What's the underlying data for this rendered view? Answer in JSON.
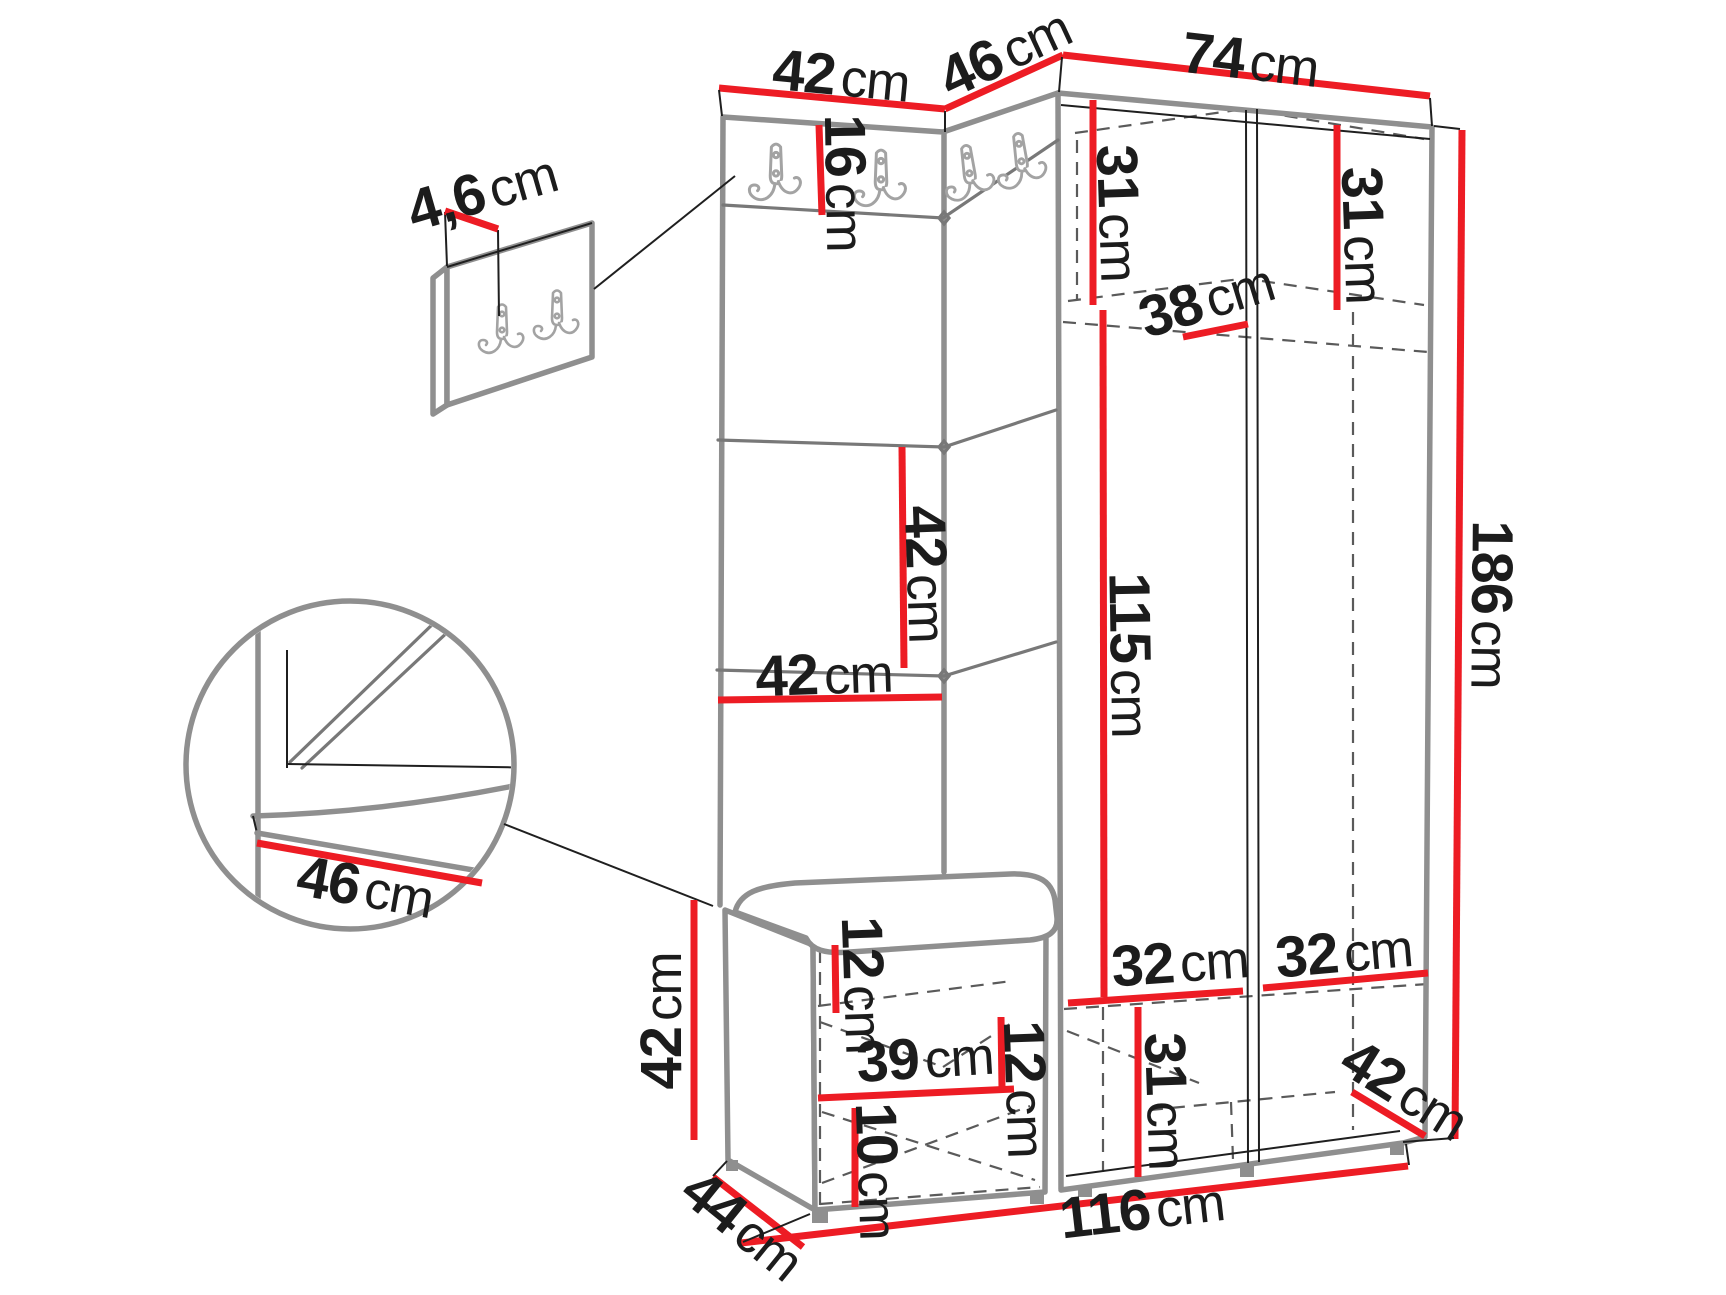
{
  "colors": {
    "dimension_red": "#ed1c24",
    "outline_grey": "#8f8f8f",
    "seam_grey": "#787878",
    "line_black": "#1f1f1f",
    "dash_grey": "#5a5a5a",
    "hook_grey": "#a3a3a3",
    "text_black": "#1c1c1c"
  },
  "dims": {
    "panel_top_width": {
      "v": "42",
      "u": "cm"
    },
    "corner_top_width": {
      "v": "46",
      "u": "cm"
    },
    "wardrobe_top_width": {
      "v": "74",
      "u": "cm"
    },
    "hook_panel_thickness": {
      "v": "4,6",
      "u": "cm"
    },
    "hook_header_height": {
      "v": "16",
      "u": "cm"
    },
    "top_shelf_left_height": {
      "v": "31",
      "u": "cm"
    },
    "top_shelf_right_height": {
      "v": "31",
      "u": "cm"
    },
    "top_shelf_depth": {
      "v": "38",
      "u": "cm"
    },
    "cushion_height": {
      "v": "42",
      "u": "cm"
    },
    "cushion_width": {
      "v": "42",
      "u": "cm"
    },
    "open_section_height": {
      "v": "115",
      "u": "cm"
    },
    "total_height": {
      "v": "186",
      "u": "cm"
    },
    "seat_depth_detail": {
      "v": "46",
      "u": "cm"
    },
    "bench_height": {
      "v": "42",
      "u": "cm"
    },
    "bench_top_offset": {
      "v": "12",
      "u": "cm"
    },
    "bench_inner_width": {
      "v": "39",
      "u": "cm"
    },
    "bench_shelf_offset": {
      "v": "12",
      "u": "cm"
    },
    "bench_bottom_height": {
      "v": "10",
      "u": "cm"
    },
    "bottom_section_height": {
      "v": "31",
      "u": "cm"
    },
    "bottom_left_width": {
      "v": "32",
      "u": "cm"
    },
    "bottom_right_width": {
      "v": "32",
      "u": "cm"
    },
    "bottom_depth_right": {
      "v": "42",
      "u": "cm"
    },
    "unit_depth": {
      "v": "44",
      "u": "cm"
    },
    "total_width": {
      "v": "116",
      "u": "cm"
    }
  }
}
